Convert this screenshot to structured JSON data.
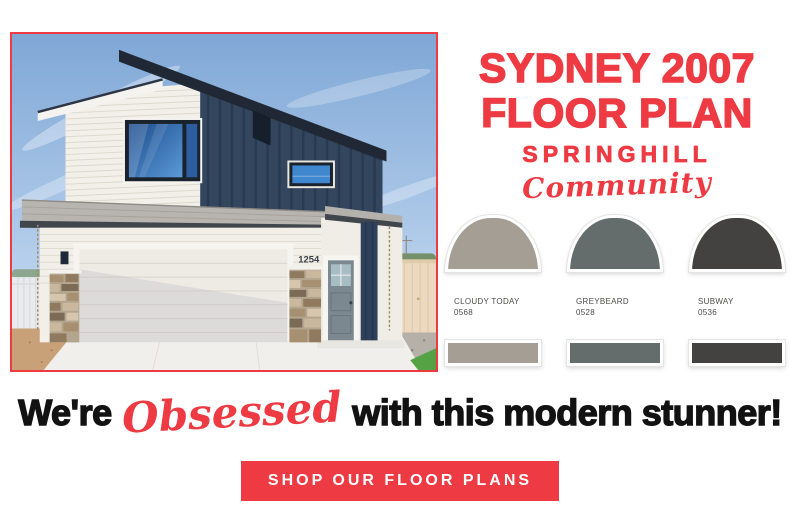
{
  "colors": {
    "accent_red": "#ee3a42",
    "headline_black": "#121212",
    "page_background": "#ffffff"
  },
  "title": {
    "line1": "SYDNEY 2007",
    "line2": "FLOOR PLAN",
    "subtitle": "SPRINGHILL",
    "script": "Community"
  },
  "photo": {
    "description": "modern two-story home with white lap siding, navy board-and-batten, stone accents and white two-car garage",
    "house_number": "1254",
    "border_color": "#ee3a42"
  },
  "swatches": [
    {
      "name": "CLOUDY TODAY",
      "code": "0568",
      "color": "#a59e95"
    },
    {
      "name": "GREYBEARD",
      "code": "0528",
      "color": "#646c6c"
    },
    {
      "name": "SUBWAY",
      "code": "0536",
      "color": "#434240"
    }
  ],
  "headline": {
    "prefix": "We're",
    "emphasis": "Obsessed",
    "suffix": "with this modern stunner!"
  },
  "cta": {
    "label": "SHOP OUR FLOOR PLANS"
  }
}
